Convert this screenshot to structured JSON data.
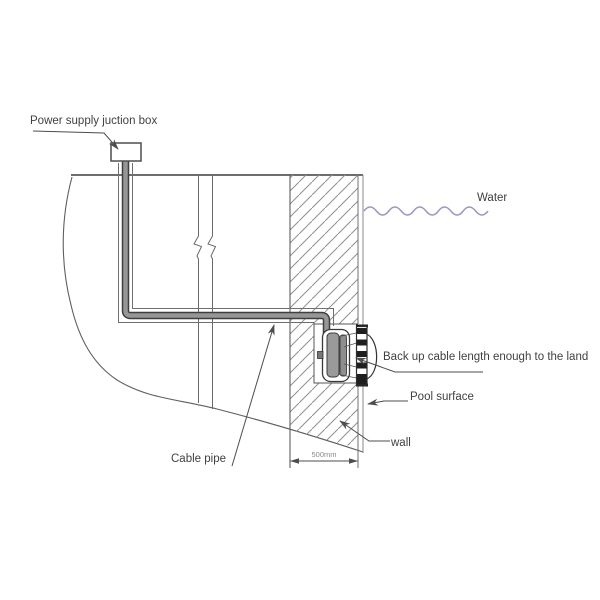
{
  "diagram": {
    "type": "pool-light-installation-technical-drawing",
    "labels": {
      "power_box": "Power supply juction box",
      "water": "Water",
      "backup_cable": "Back up cable length enough to the land",
      "pool_surface": "Pool surface",
      "wall": "wall",
      "cable_pipe": "Cable pipe"
    },
    "dimension": {
      "wall_thickness": "500mm"
    },
    "colors": {
      "line": "#4d4d4d",
      "water_line": "#9797cb",
      "cable_fill": "#969696",
      "coil_fill": "#9a9a9a",
      "hatch_line": "#909090",
      "label_text": "#414141",
      "dim_text": "#8a8a8a"
    }
  }
}
